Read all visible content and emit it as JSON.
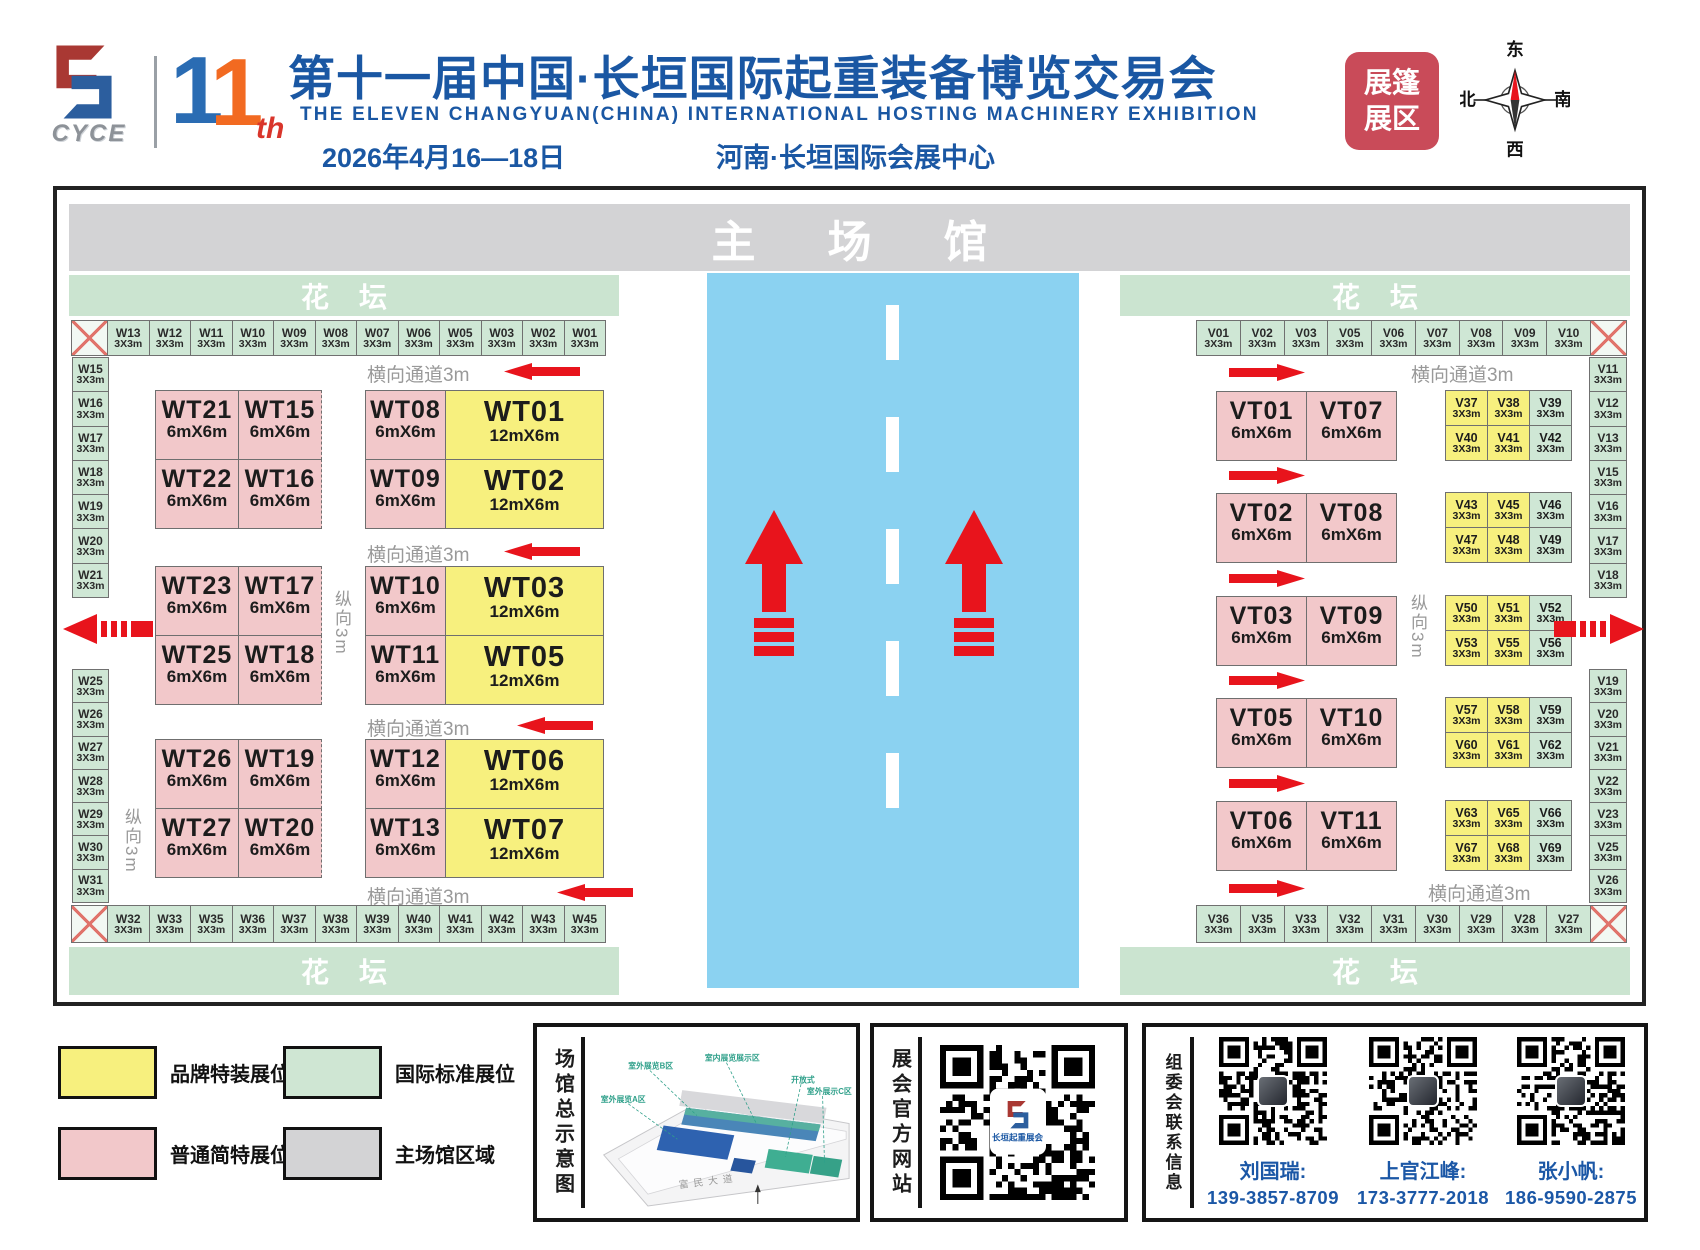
{
  "header": {
    "logo_text": "CYCE",
    "edition_number_1": "1",
    "edition_number_2": "1",
    "edition_suffix": "th",
    "title_cn": "第十一届中国·长垣国际起重装备博览交易会",
    "title_en": "THE ELEVEN CHANGYUAN(CHINA) INTERNATIONAL HOSTING MACHINERY EXHIBITION",
    "date": "2026年4月16—18日",
    "venue": "河南·长垣国际会展中心",
    "badge_line1": "展篷",
    "badge_line2": "展区",
    "compass": {
      "top": "东",
      "right": "南",
      "bottom": "西",
      "left": "北"
    }
  },
  "map": {
    "main_hall_label": "主场馆",
    "flower_bed_label": "花坛",
    "aisle_h_label": "横向通道3m",
    "aisle_v_label": "纵向3m",
    "left": {
      "top_row": [
        {
          "kind": "cross"
        },
        {
          "id": "W13",
          "size": "3X3m",
          "kind": "std"
        },
        {
          "id": "W12",
          "size": "3X3m",
          "kind": "std"
        },
        {
          "id": "W11",
          "size": "3X3m",
          "kind": "std"
        },
        {
          "id": "W10",
          "size": "3X3m",
          "kind": "std"
        },
        {
          "id": "W09",
          "size": "3X3m",
          "kind": "std"
        },
        {
          "id": "W08",
          "size": "3X3m",
          "kind": "std"
        },
        {
          "id": "W07",
          "size": "3X3m",
          "kind": "std"
        },
        {
          "id": "W06",
          "size": "3X3m",
          "kind": "std"
        },
        {
          "id": "W05",
          "size": "3X3m",
          "kind": "std"
        },
        {
          "id": "W03",
          "size": "3X3m",
          "kind": "std"
        },
        {
          "id": "W02",
          "size": "3X3m",
          "kind": "std"
        },
        {
          "id": "W01",
          "size": "3X3m",
          "kind": "std"
        }
      ],
      "col_top": [
        {
          "id": "W15",
          "size": "3X3m",
          "kind": "std"
        },
        {
          "id": "W16",
          "size": "3X3m",
          "kind": "std"
        },
        {
          "id": "W17",
          "size": "3X3m",
          "kind": "std"
        },
        {
          "id": "W18",
          "size": "3X3m",
          "kind": "std"
        },
        {
          "id": "W19",
          "size": "3X3m",
          "kind": "std"
        },
        {
          "id": "W20",
          "size": "3X3m",
          "kind": "std"
        },
        {
          "id": "W21",
          "size": "3X3m",
          "kind": "std"
        }
      ],
      "col_bottom": [
        {
          "id": "W25",
          "size": "3X3m",
          "kind": "std"
        },
        {
          "id": "W26",
          "size": "3X3m",
          "kind": "std"
        },
        {
          "id": "W27",
          "size": "3X3m",
          "kind": "std"
        },
        {
          "id": "W28",
          "size": "3X3m",
          "kind": "std"
        },
        {
          "id": "W29",
          "size": "3X3m",
          "kind": "std"
        },
        {
          "id": "W30",
          "size": "3X3m",
          "kind": "std"
        },
        {
          "id": "W31",
          "size": "3X3m",
          "kind": "std"
        }
      ],
      "bottom_row": [
        {
          "kind": "cross"
        },
        {
          "id": "W32",
          "size": "3X3m",
          "kind": "std"
        },
        {
          "id": "W33",
          "size": "3X3m",
          "kind": "std"
        },
        {
          "id": "W35",
          "size": "3X3m",
          "kind": "std"
        },
        {
          "id": "W36",
          "size": "3X3m",
          "kind": "std"
        },
        {
          "id": "W37",
          "size": "3X3m",
          "kind": "std"
        },
        {
          "id": "W38",
          "size": "3X3m",
          "kind": "std"
        },
        {
          "id": "W39",
          "size": "3X3m",
          "kind": "std"
        },
        {
          "id": "W40",
          "size": "3X3m",
          "kind": "std"
        },
        {
          "id": "W41",
          "size": "3X3m",
          "kind": "std"
        },
        {
          "id": "W42",
          "size": "3X3m",
          "kind": "std"
        },
        {
          "id": "W43",
          "size": "3X3m",
          "kind": "std"
        },
        {
          "id": "W45",
          "size": "3X3m",
          "kind": "std"
        }
      ],
      "booth_rows": [
        {
          "a": "WT21",
          "b": "WT15",
          "c": "WT08",
          "d": "WT01",
          "s": "6mX6m",
          "ws": "12mX6m"
        },
        {
          "a": "WT22",
          "b": "WT16",
          "c": "WT09",
          "d": "WT02",
          "s": "6mX6m",
          "ws": "12mX6m"
        },
        {
          "a": "WT23",
          "b": "WT17",
          "c": "WT10",
          "d": "WT03",
          "s": "6mX6m",
          "ws": "12mX6m"
        },
        {
          "a": "WT25",
          "b": "WT18",
          "c": "WT11",
          "d": "WT05",
          "s": "6mX6m",
          "ws": "12mX6m"
        },
        {
          "a": "WT26",
          "b": "WT19",
          "c": "WT12",
          "d": "WT06",
          "s": "6mX6m",
          "ws": "12mX6m"
        },
        {
          "a": "WT27",
          "b": "WT20",
          "c": "WT13",
          "d": "WT07",
          "s": "6mX6m",
          "ws": "12mX6m"
        }
      ]
    },
    "right": {
      "top_row": [
        {
          "id": "V01",
          "size": "3X3m",
          "kind": "std"
        },
        {
          "id": "V02",
          "size": "3X3m",
          "kind": "std"
        },
        {
          "id": "V03",
          "size": "3X3m",
          "kind": "std"
        },
        {
          "id": "V05",
          "size": "3X3m",
          "kind": "std"
        },
        {
          "id": "V06",
          "size": "3X3m",
          "kind": "std"
        },
        {
          "id": "V07",
          "size": "3X3m",
          "kind": "std"
        },
        {
          "id": "V08",
          "size": "3X3m",
          "kind": "std"
        },
        {
          "id": "V09",
          "size": "3X3m",
          "kind": "std"
        },
        {
          "id": "V10",
          "size": "3X3m",
          "kind": "std"
        },
        {
          "kind": "cross"
        }
      ],
      "col_top": [
        {
          "id": "V11",
          "size": "3X3m",
          "kind": "std"
        },
        {
          "id": "V12",
          "size": "3X3m",
          "kind": "std"
        },
        {
          "id": "V13",
          "size": "3X3m",
          "kind": "std"
        },
        {
          "id": "V15",
          "size": "3X3m",
          "kind": "std"
        },
        {
          "id": "V16",
          "size": "3X3m",
          "kind": "std"
        },
        {
          "id": "V17",
          "size": "3X3m",
          "kind": "std"
        },
        {
          "id": "V18",
          "size": "3X3m",
          "kind": "std"
        }
      ],
      "col_bottom": [
        {
          "id": "V19",
          "size": "3X3m",
          "kind": "std"
        },
        {
          "id": "V20",
          "size": "3X3m",
          "kind": "std"
        },
        {
          "id": "V21",
          "size": "3X3m",
          "kind": "std"
        },
        {
          "id": "V22",
          "size": "3X3m",
          "kind": "std"
        },
        {
          "id": "V23",
          "size": "3X3m",
          "kind": "std"
        },
        {
          "id": "V25",
          "size": "3X3m",
          "kind": "std"
        },
        {
          "id": "V26",
          "size": "3X3m",
          "kind": "std"
        }
      ],
      "bottom_row": [
        {
          "id": "V36",
          "size": "3X3m",
          "kind": "std"
        },
        {
          "id": "V35",
          "size": "3X3m",
          "kind": "std"
        },
        {
          "id": "V33",
          "size": "3X3m",
          "kind": "std"
        },
        {
          "id": "V32",
          "size": "3X3m",
          "kind": "std"
        },
        {
          "id": "V31",
          "size": "3X3m",
          "kind": "std"
        },
        {
          "id": "V30",
          "size": "3X3m",
          "kind": "std"
        },
        {
          "id": "V29",
          "size": "3X3m",
          "kind": "std"
        },
        {
          "id": "V28",
          "size": "3X3m",
          "kind": "std"
        },
        {
          "id": "V27",
          "size": "3X3m",
          "kind": "std"
        },
        {
          "kind": "cross"
        }
      ],
      "vt_rows": [
        {
          "a": "VT01",
          "b": "VT07",
          "s": "6mX6m"
        },
        {
          "a": "VT02",
          "b": "VT08",
          "s": "6mX6m"
        },
        {
          "a": "VT03",
          "b": "VT09",
          "s": "6mX6m"
        },
        {
          "a": "VT05",
          "b": "VT10",
          "s": "6mX6m"
        },
        {
          "a": "VT06",
          "b": "VT11",
          "s": "6mX6m"
        }
      ],
      "v_groups": [
        [
          {
            "id": "V37",
            "size": "3X3m",
            "kind": "vy"
          },
          {
            "id": "V38",
            "size": "3X3m",
            "kind": "vy"
          },
          {
            "id": "V39",
            "size": "3X3m",
            "kind": "vg"
          },
          {
            "id": "V40",
            "size": "3X3m",
            "kind": "vy"
          },
          {
            "id": "V41",
            "size": "3X3m",
            "kind": "vy"
          },
          {
            "id": "V42",
            "size": "3X3m",
            "kind": "vg"
          }
        ],
        [
          {
            "id": "V43",
            "size": "3X3m",
            "kind": "vy"
          },
          {
            "id": "V45",
            "size": "3X3m",
            "kind": "vy"
          },
          {
            "id": "V46",
            "size": "3X3m",
            "kind": "vg"
          },
          {
            "id": "V47",
            "size": "3X3m",
            "kind": "vy"
          },
          {
            "id": "V48",
            "size": "3X3m",
            "kind": "vy"
          },
          {
            "id": "V49",
            "size": "3X3m",
            "kind": "vg"
          }
        ],
        [
          {
            "id": "V50",
            "size": "3X3m",
            "kind": "vy"
          },
          {
            "id": "V51",
            "size": "3X3m",
            "kind": "vy"
          },
          {
            "id": "V52",
            "size": "3X3m",
            "kind": "vg"
          },
          {
            "id": "V53",
            "size": "3X3m",
            "kind": "vy"
          },
          {
            "id": "V55",
            "size": "3X3m",
            "kind": "vy"
          },
          {
            "id": "V56",
            "size": "3X3m",
            "kind": "vg"
          }
        ],
        [
          {
            "id": "V57",
            "size": "3X3m",
            "kind": "vy"
          },
          {
            "id": "V58",
            "size": "3X3m",
            "kind": "vy"
          },
          {
            "id": "V59",
            "size": "3X3m",
            "kind": "vg"
          },
          {
            "id": "V60",
            "size": "3X3m",
            "kind": "vy"
          },
          {
            "id": "V61",
            "size": "3X3m",
            "kind": "vy"
          },
          {
            "id": "V62",
            "size": "3X3m",
            "kind": "vg"
          }
        ],
        [
          {
            "id": "V63",
            "size": "3X3m",
            "kind": "vy"
          },
          {
            "id": "V65",
            "size": "3X3m",
            "kind": "vy"
          },
          {
            "id": "V66",
            "size": "3X3m",
            "kind": "vg"
          },
          {
            "id": "V67",
            "size": "3X3m",
            "kind": "vy"
          },
          {
            "id": "V68",
            "size": "3X3m",
            "kind": "vy"
          },
          {
            "id": "V69",
            "size": "3X3m",
            "kind": "vg"
          }
        ]
      ]
    }
  },
  "legend": {
    "items": [
      {
        "label": "品牌特装展位",
        "kind": "lgy",
        "color": "#f7f07e"
      },
      {
        "label": "国际标准展位",
        "kind": "lgg",
        "color": "#cfe6d3"
      },
      {
        "label": "普通简特展位",
        "kind": "lgp",
        "color": "#f2c8ca"
      },
      {
        "label": "主场馆区域",
        "kind": "lgm",
        "color": "#d3d3d5"
      }
    ]
  },
  "panels": {
    "site_map": {
      "title": "场馆总示意图",
      "callouts": [
        "室外展览B区",
        "室内展览展示区",
        "开放式",
        "室外展示C区",
        "室外展览A区"
      ],
      "road_label": "富民大道"
    },
    "website": {
      "title": "展会官方网站",
      "qr_caption": "长垣起重展会"
    },
    "contacts": {
      "title": "组委会联系信息",
      "people": [
        {
          "name": "刘国瑞:",
          "phone": "139-3857-8709"
        },
        {
          "name": "上官江峰:",
          "phone": "173-3777-2018"
        },
        {
          "name": "张小帆:",
          "phone": "186-9590-2875"
        }
      ]
    }
  },
  "colors": {
    "accent_red": "#e8141c",
    "title_blue": "#1a57a3",
    "badge_red": "#c94b59",
    "booth_yellow": "#f7f07e",
    "booth_pink": "#f2c8ca",
    "booth_green": "#cfe7d5",
    "hall_gray": "#d3d3d5",
    "road_blue": "#8bd2f1"
  }
}
